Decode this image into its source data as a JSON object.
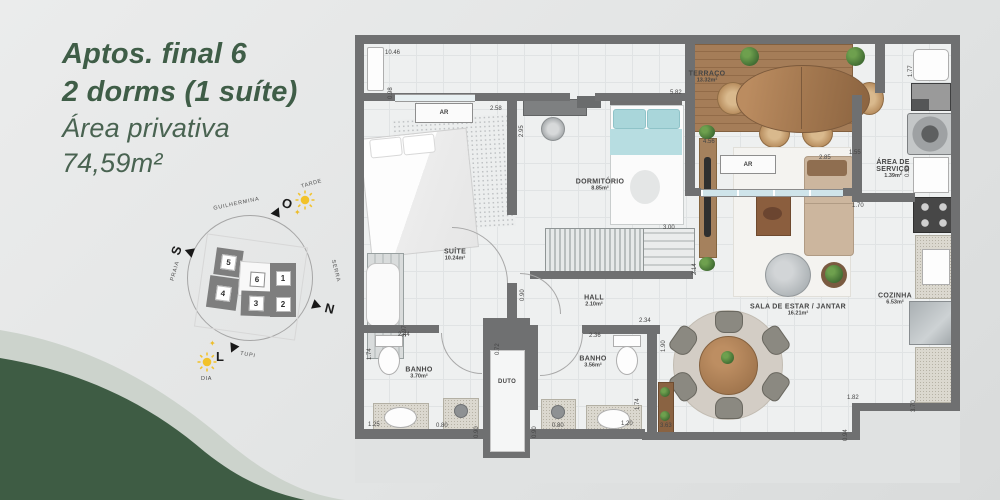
{
  "headline": {
    "line1": "Aptos. final 6",
    "line2": "2 dorms (1 suíte)",
    "line3": "Área privativa",
    "line4": "74,59m²"
  },
  "colors": {
    "accent_green": "#3f5d47",
    "wave_green": "#3e5c44",
    "wave_band": "#ccd3cc",
    "wall_gray": "#6f7071",
    "sun_yellow": "#f2c229"
  },
  "compass": {
    "cardinals": [
      {
        "label": "O"
      },
      {
        "label": "S"
      },
      {
        "label": "N"
      },
      {
        "label": "L"
      }
    ],
    "streets": [
      {
        "label": "GUILHERMINA"
      },
      {
        "label": "PRAIA"
      },
      {
        "label": "SERRA"
      },
      {
        "label": "TUPI"
      }
    ],
    "sun_labels": [
      {
        "label": "TARDE"
      },
      {
        "label": "DIA"
      }
    ],
    "blocks": [
      {
        "num": "1"
      },
      {
        "num": "2"
      },
      {
        "num": "3"
      },
      {
        "num": "4"
      },
      {
        "num": "5"
      },
      {
        "num": "6",
        "highlighted": true
      }
    ]
  },
  "plan": {
    "ac_label": "AR",
    "rooms": [
      {
        "line1": "TERRAÇO",
        "area": "13.32m²"
      },
      {
        "line1": "DORMITÓRIO",
        "area": "8.85m²"
      },
      {
        "line1": "SUÍTE",
        "area": "10.24m²"
      },
      {
        "line1": "ÁREA DE",
        "line2": "SERVIÇO",
        "area": "1.39m²"
      },
      {
        "line1": "COZINHA",
        "area": "6.53m²"
      },
      {
        "line1": "SALA DE ESTAR / JANTAR",
        "area": "16.21m²"
      },
      {
        "line1": "HALL",
        "area": "2.10m²"
      },
      {
        "line1": "BANHO",
        "area": "3.70m²"
      },
      {
        "line1": "BANHO",
        "area": "3.56m²"
      },
      {
        "line1": "DUTO"
      }
    ],
    "dimensions": [
      {
        "t": "10.46",
        "x": 30,
        "y": 15
      },
      {
        "t": "0.98",
        "x": 33,
        "y": 52,
        "v": 1
      },
      {
        "t": "2.58",
        "x": 135,
        "y": 71
      },
      {
        "t": "2.95",
        "x": 164,
        "y": 90,
        "v": 1
      },
      {
        "t": "5.82",
        "x": 315,
        "y": 55
      },
      {
        "t": "4.56",
        "x": 348,
        "y": 104
      },
      {
        "t": "3.00",
        "x": 308,
        "y": 190
      },
      {
        "t": "2.14",
        "x": 337,
        "y": 228,
        "v": 1
      },
      {
        "t": "1.77",
        "x": 553,
        "y": 30,
        "v": 1
      },
      {
        "t": "1.55",
        "x": 494,
        "y": 115
      },
      {
        "t": "0.90",
        "x": 550,
        "y": 130,
        "v": 1
      },
      {
        "t": "2.85",
        "x": 464,
        "y": 120
      },
      {
        "t": "1.70",
        "x": 497,
        "y": 168
      },
      {
        "t": "3.70",
        "x": 556,
        "y": 365,
        "v": 1
      },
      {
        "t": "1.82",
        "x": 492,
        "y": 360
      },
      {
        "t": "0.94",
        "x": 488,
        "y": 394,
        "v": 1
      },
      {
        "t": "2.34",
        "x": 284,
        "y": 283
      },
      {
        "t": "1.90",
        "x": 306,
        "y": 305,
        "v": 1
      },
      {
        "t": "2.36",
        "x": 234,
        "y": 298
      },
      {
        "t": "1.74",
        "x": 280,
        "y": 363,
        "v": 1
      },
      {
        "t": "1.20",
        "x": 266,
        "y": 386
      },
      {
        "t": "3.63",
        "x": 305,
        "y": 388
      },
      {
        "t": "0.80",
        "x": 197,
        "y": 388
      },
      {
        "t": "0.90",
        "x": 177,
        "y": 391,
        "v": 1
      },
      {
        "t": "0.72",
        "x": 140,
        "y": 308,
        "v": 1
      },
      {
        "t": "0.90",
        "x": 119,
        "y": 391,
        "v": 1
      },
      {
        "t": "0.80",
        "x": 81,
        "y": 388
      },
      {
        "t": "1.25",
        "x": 13,
        "y": 387
      },
      {
        "t": "2.44",
        "x": 43,
        "y": 297
      },
      {
        "t": "1.74",
        "x": 12,
        "y": 313,
        "v": 1
      },
      {
        "t": "3.97",
        "x": 47,
        "y": 290,
        "v": 1
      },
      {
        "t": "0.90",
        "x": 165,
        "y": 254,
        "v": 1
      }
    ]
  }
}
